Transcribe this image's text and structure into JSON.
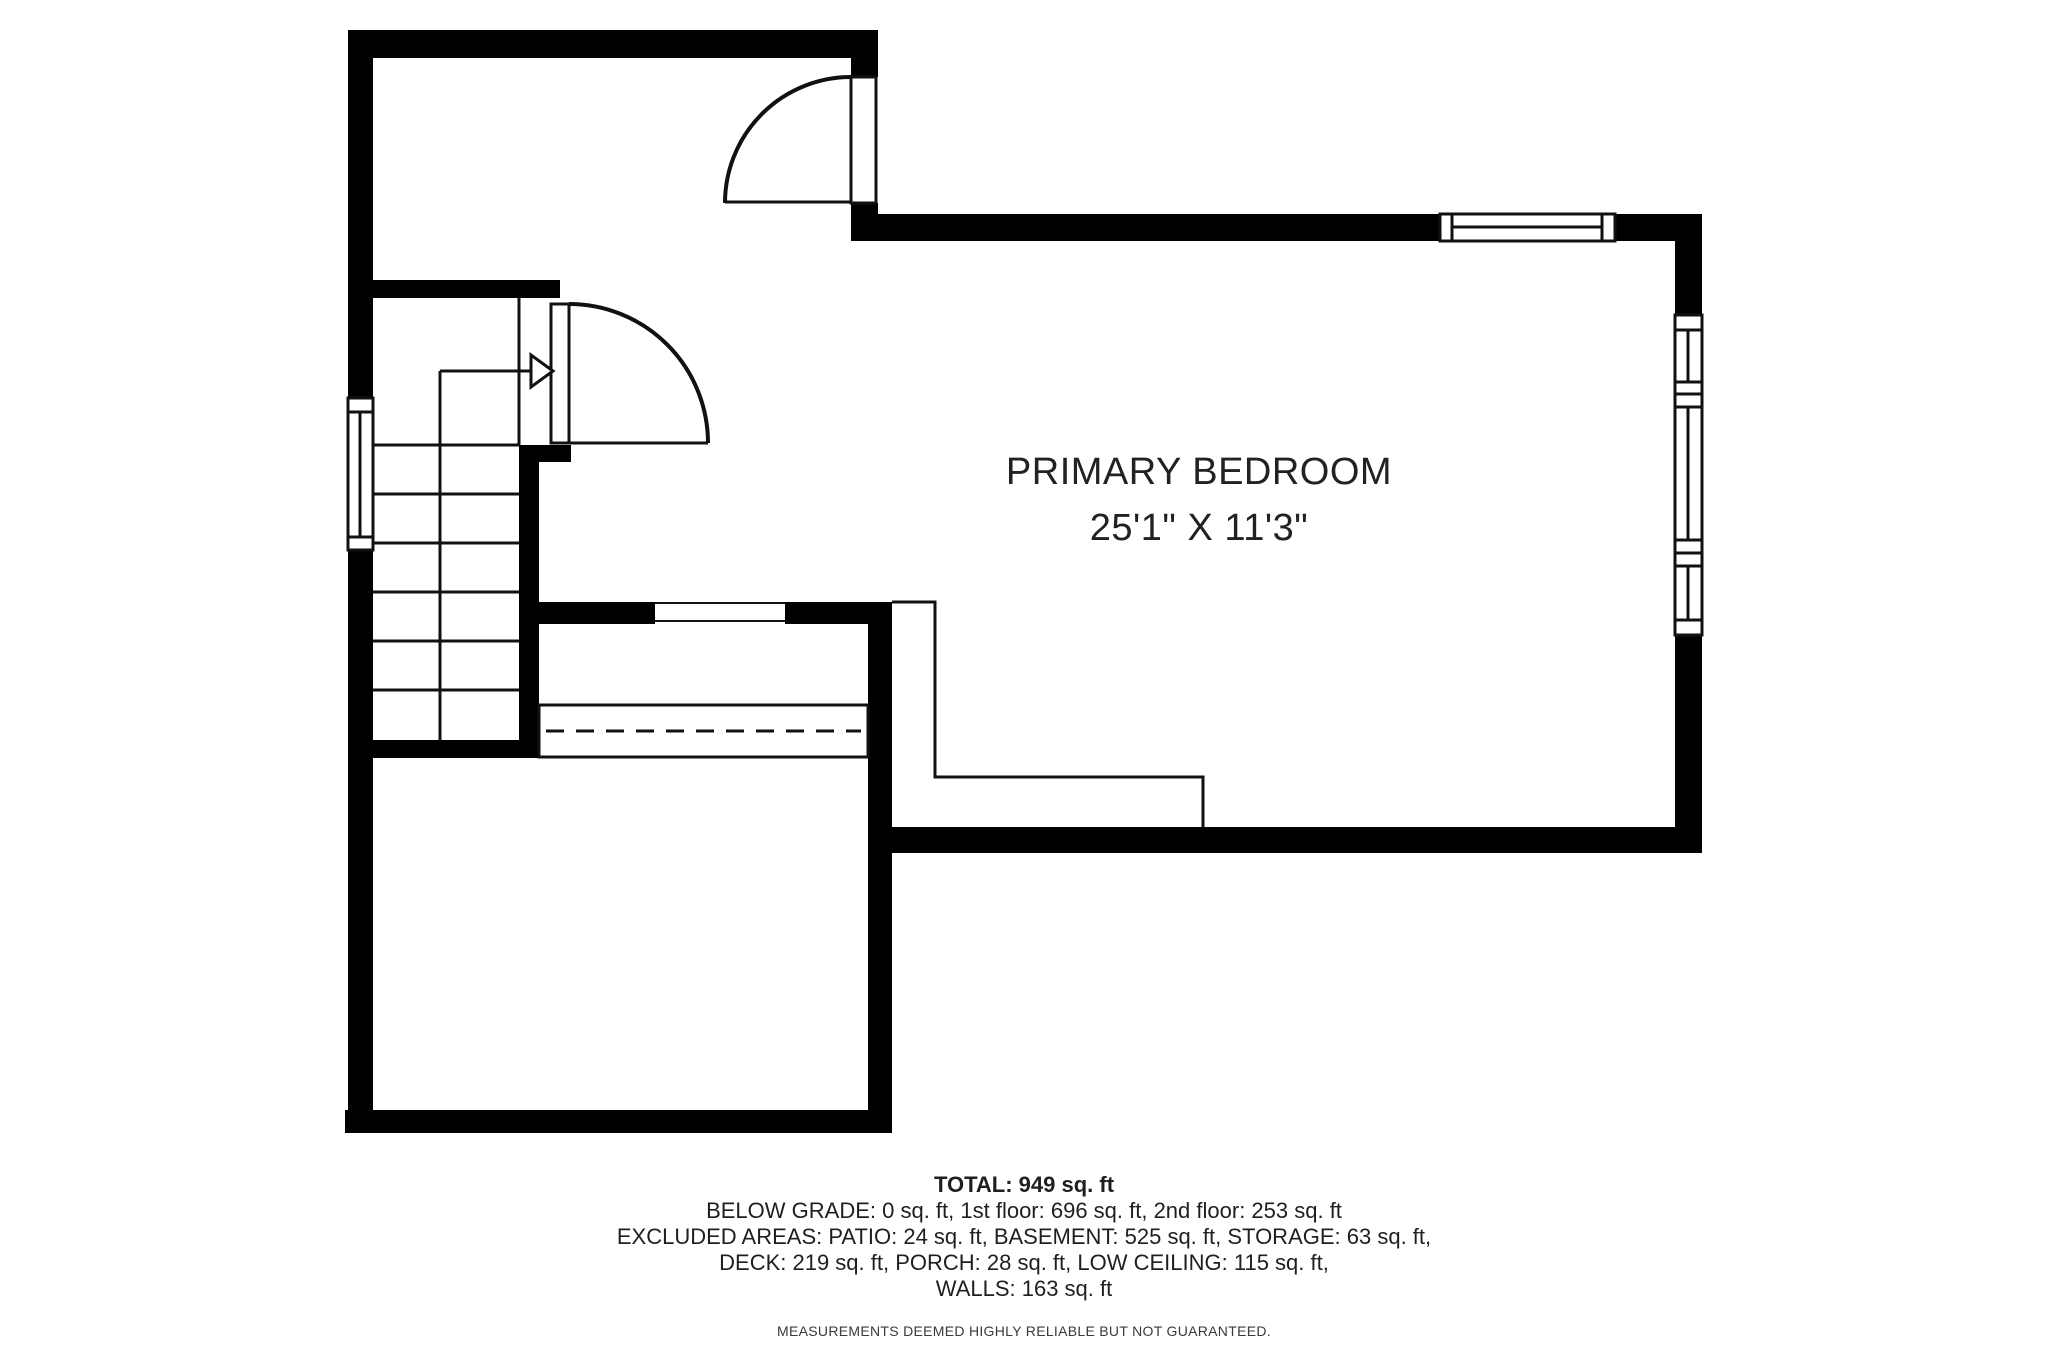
{
  "plan": {
    "room": {
      "label": "PRIMARY BEDROOM",
      "dimensions": "25'1\" X 11'3\""
    },
    "summary": {
      "total": "TOTAL: 949 sq. ft",
      "lines": [
        "BELOW GRADE: 0 sq. ft, 1st floor: 696 sq. ft, 2nd floor: 253 sq. ft",
        "EXCLUDED AREAS: PATIO: 24 sq. ft, BASEMENT: 525 sq. ft, STORAGE: 63 sq. ft,",
        "DECK: 219 sq. ft, PORCH: 28 sq. ft, LOW CEILING: 115 sq. ft,",
        "WALLS: 163 sq. ft"
      ],
      "disclaimer": "MEASUREMENTS DEEMED HIGHLY RELIABLE BUT NOT GUARANTEED."
    },
    "colors": {
      "walls": "#000000",
      "lines": "#111111",
      "text": "#222222",
      "muted_text": "#3a3a3a",
      "background": "#ffffff"
    }
  }
}
